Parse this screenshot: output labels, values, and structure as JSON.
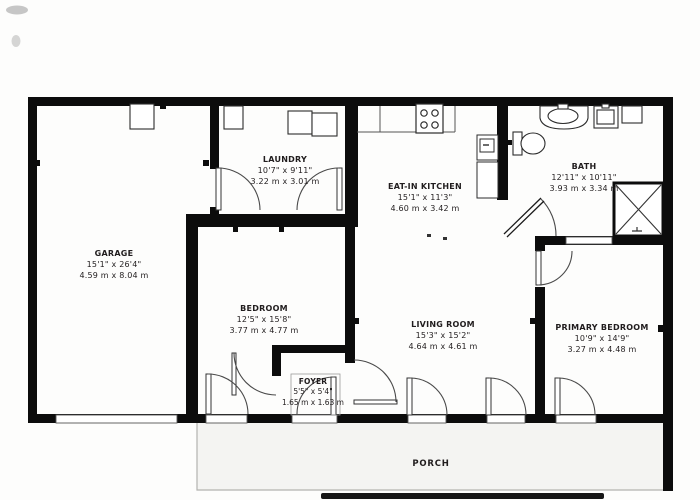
{
  "plan_title": "Floor Plan",
  "rooms": {
    "garage": {
      "name": "GARAGE",
      "imperial": "15'1\" x 26'4\"",
      "metric": "4.59 m x 8.04 m"
    },
    "laundry": {
      "name": "LAUNDRY",
      "imperial": "10'7\" x 9'11\"",
      "metric": "3.22 m x 3.01 m"
    },
    "kitchen": {
      "name": "EAT-IN KITCHEN",
      "imperial": "15'1\" x 11'3\"",
      "metric": "4.60 m x 3.42 m"
    },
    "bath": {
      "name": "BATH",
      "imperial": "12'11\" x 10'11\"",
      "metric": "3.93 m x 3.34 m"
    },
    "bedroom": {
      "name": "BEDROOM",
      "imperial": "12'5\" x 15'8\"",
      "metric": "3.77 m x 4.77 m"
    },
    "living": {
      "name": "LIVING ROOM",
      "imperial": "15'3\" x 15'2\"",
      "metric": "4.64 m x 4.61 m"
    },
    "primary": {
      "name": "PRIMARY BEDROOM",
      "imperial": "10'9\" x 14'9\"",
      "metric": "3.27 m x 4.48 m"
    },
    "foyer": {
      "name": "FOYER",
      "imperial": "5'5\" x 5'4\"",
      "metric": "1.65 m x 1.63 m"
    },
    "porch": {
      "name": "PORCH"
    }
  },
  "colors": {
    "wall": "#0c0c0c",
    "fixture_line": "#2c2c2c",
    "door_arc": "#4a4a4a",
    "thin_line": "#9a9a9a",
    "porch_fill": "#f4f4f2",
    "text": "#211d1e",
    "background": "#fdfdfc"
  }
}
